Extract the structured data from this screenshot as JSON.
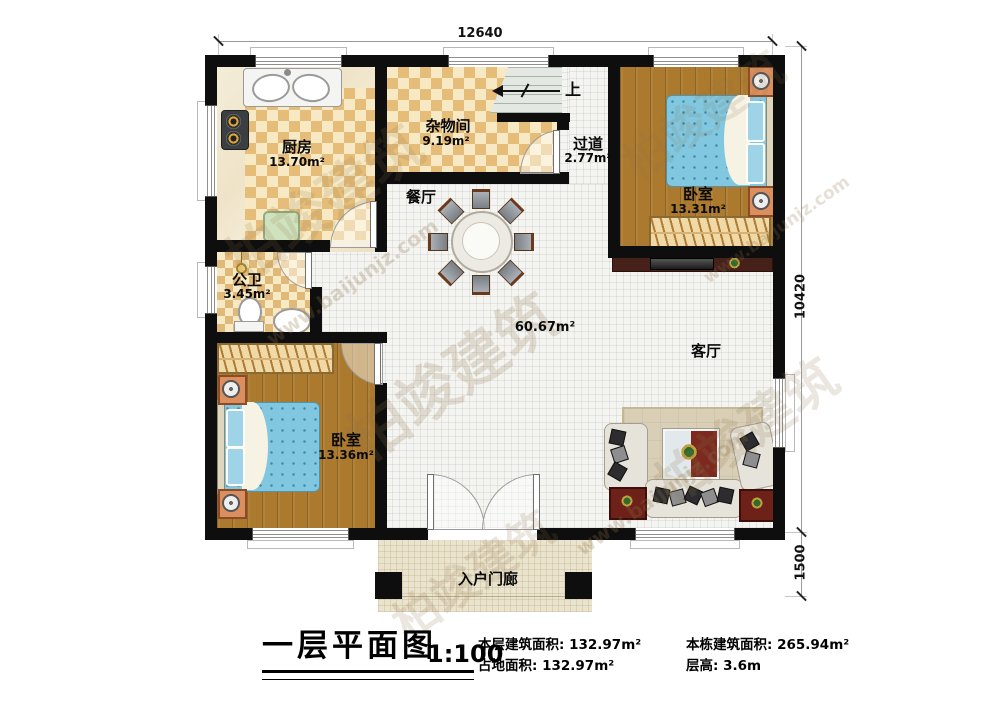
{
  "plan": {
    "dims": {
      "width_mm": "12640",
      "height_mm": "10420",
      "porch_mm": "1500"
    },
    "rooms": {
      "kitchen": {
        "name": "厨房",
        "area": "13.70m²"
      },
      "storage": {
        "name": "杂物间",
        "area": "9.19m²"
      },
      "hallway": {
        "name": "过道",
        "area": "2.77m²"
      },
      "bedroom_top": {
        "name": "卧室",
        "area": "13.31m²"
      },
      "bathroom": {
        "name": "公卫",
        "area": "3.45m²"
      },
      "bedroom_left": {
        "name": "卧室",
        "area": "13.36m²"
      },
      "dining": {
        "name": "餐厅"
      },
      "living": {
        "name": "客厅"
      },
      "porch": {
        "name": "入户门廊"
      }
    },
    "open_area": "60.67m²",
    "stairs_label": "上"
  },
  "title_block": {
    "title": "一层平面图",
    "scale": "1:100",
    "stats": [
      {
        "label": "本层建筑面积:",
        "value": "132.97m²"
      },
      {
        "label": "占地面积:",
        "value": "132.97m²"
      },
      {
        "label": "本栋建筑面积:",
        "value": "265.94m²"
      },
      {
        "label": "层高:",
        "value": "3.6m"
      }
    ]
  },
  "watermark": {
    "brand": "柏竣建筑",
    "url": "www.baijunjz.com"
  },
  "colors": {
    "wall": "#0e0e0e",
    "checker": "#e5bd79",
    "wood": "#ab7a2e",
    "bed": "#82c7e0",
    "accent_red": "#6d2118"
  }
}
